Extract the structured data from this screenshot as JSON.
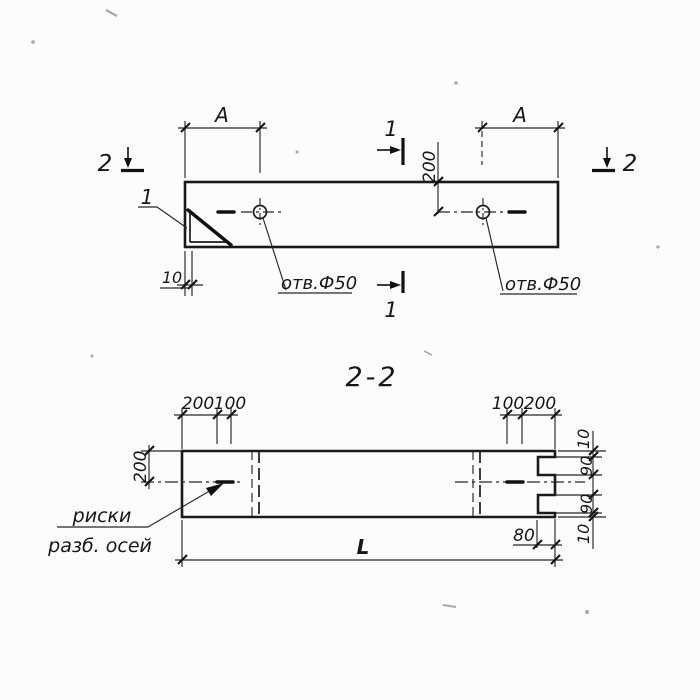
{
  "top_view": {
    "span_dim_left": "A",
    "span_dim_right": "A",
    "depth_dim": "200",
    "edge_dim": "10",
    "detail_callout": "1",
    "cut_mark_1": "1",
    "cut_mark_2": "2",
    "hole_note_left": "отв.Ф50",
    "hole_note_right": "отв.Ф50"
  },
  "section_view": {
    "title": "2-2",
    "top_left_dims": [
      "200",
      "100"
    ],
    "top_right_dims": [
      "100",
      "200"
    ],
    "side_dim": "200",
    "right_dims": [
      "10",
      "90",
      "90",
      "10"
    ],
    "notch_dim": "80",
    "length_dim": "L",
    "axes_note_line1": "риски",
    "axes_note_line2": "разб. осей"
  }
}
